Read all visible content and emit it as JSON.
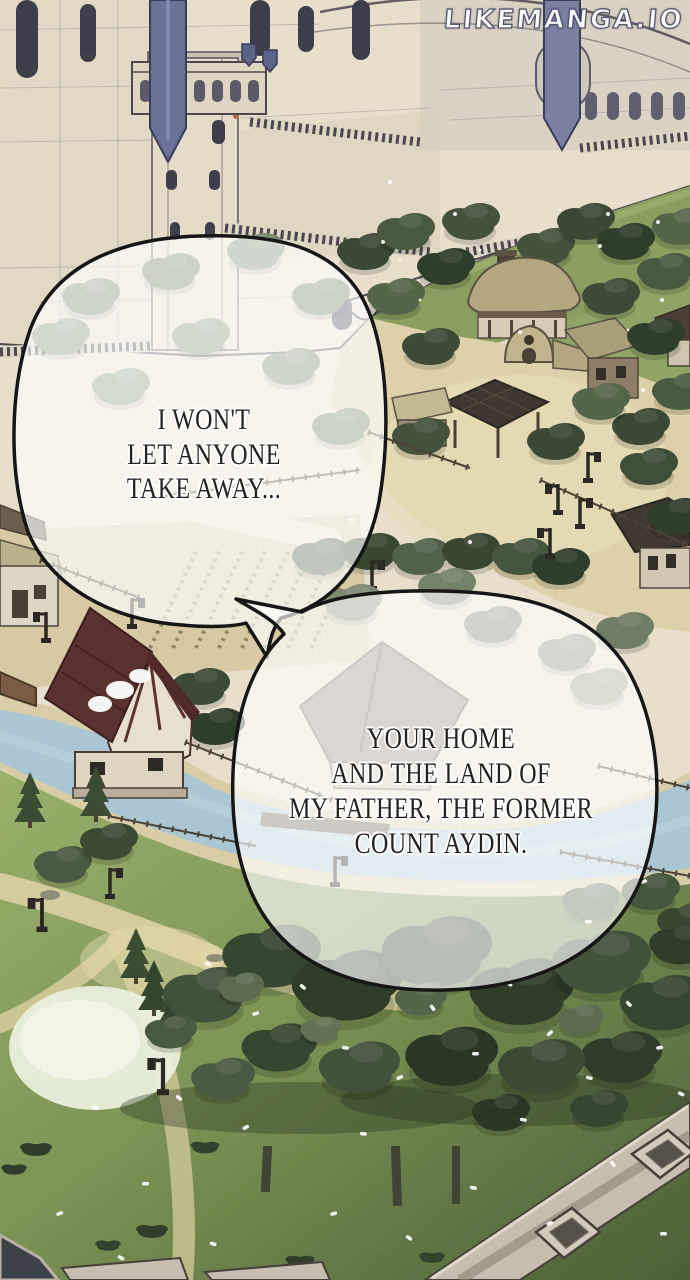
{
  "page": {
    "width": 690,
    "height": 1280,
    "media": "webtoon comic panel"
  },
  "watermark": {
    "text": "LIKEMANGA.IO"
  },
  "speech": {
    "bubble1": {
      "lines": [
        "I WON'T",
        "LET ANYONE",
        "TAKE AWAY..."
      ]
    },
    "bubble2": {
      "lines": [
        "YOUR HOME",
        "AND THE LAND OF",
        "MY FATHER, THE FORMER",
        "COUNT AYDIN."
      ]
    }
  },
  "palette": {
    "castle_stone": "#e7dfcc",
    "outline_ink": "#4b4750",
    "banner_blue": "#6b7196",
    "hill_green": "#8a9e60",
    "thatch": "#b2a77e",
    "plaza_tan": "#ddd1a9",
    "red_roof": "#5a3230",
    "river_blue": "#a9c6d2",
    "lawn_light": "#9ab06c",
    "lawn_dark": "#4c5f38",
    "tree_dark": "#2e3c28",
    "tree_mid": "#55654a",
    "stone_wall": "#c6beae",
    "bubble_fill": "#ffffff",
    "bubble_stroke": "#161616",
    "text_ink": "#242120",
    "watermark_white": "#ffffff",
    "watermark_outline": "#4d5170"
  }
}
